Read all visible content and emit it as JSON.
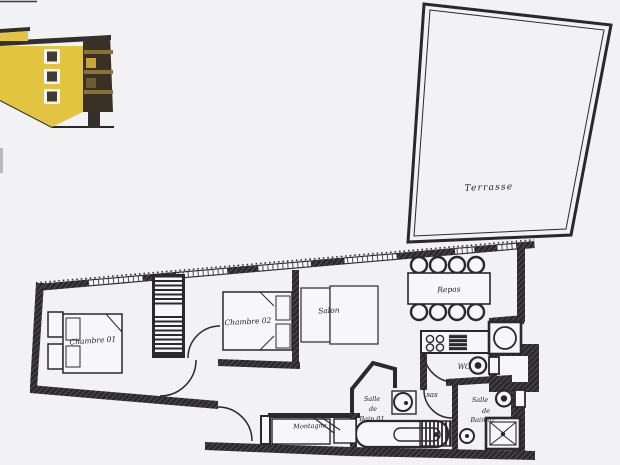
{
  "document": {
    "kind": "apartment floor plan scan"
  },
  "labels": {
    "terrasse": "Terrasse",
    "chambre01": "Chambre 01",
    "chambre02": "Chambre 02",
    "salon": "Salon",
    "repas": "Repas",
    "wc": "WC",
    "sas": "sas",
    "montagne": "Montagne",
    "sdb01_l1": "Salle",
    "sdb01_l2": "de",
    "sdb01_l3": "Bain 01",
    "sdb02_l1": "Salle",
    "sdb02_l2": "de",
    "sdb02_l3": "Bain 02"
  },
  "colors": {
    "paper": "#f2f1f4",
    "wall_dark": "#2b292d",
    "line": "#2a282c",
    "facade_yellow": "#e3c441",
    "balcony_brown": "#3a3126",
    "rail_brown": "#8a7433"
  }
}
